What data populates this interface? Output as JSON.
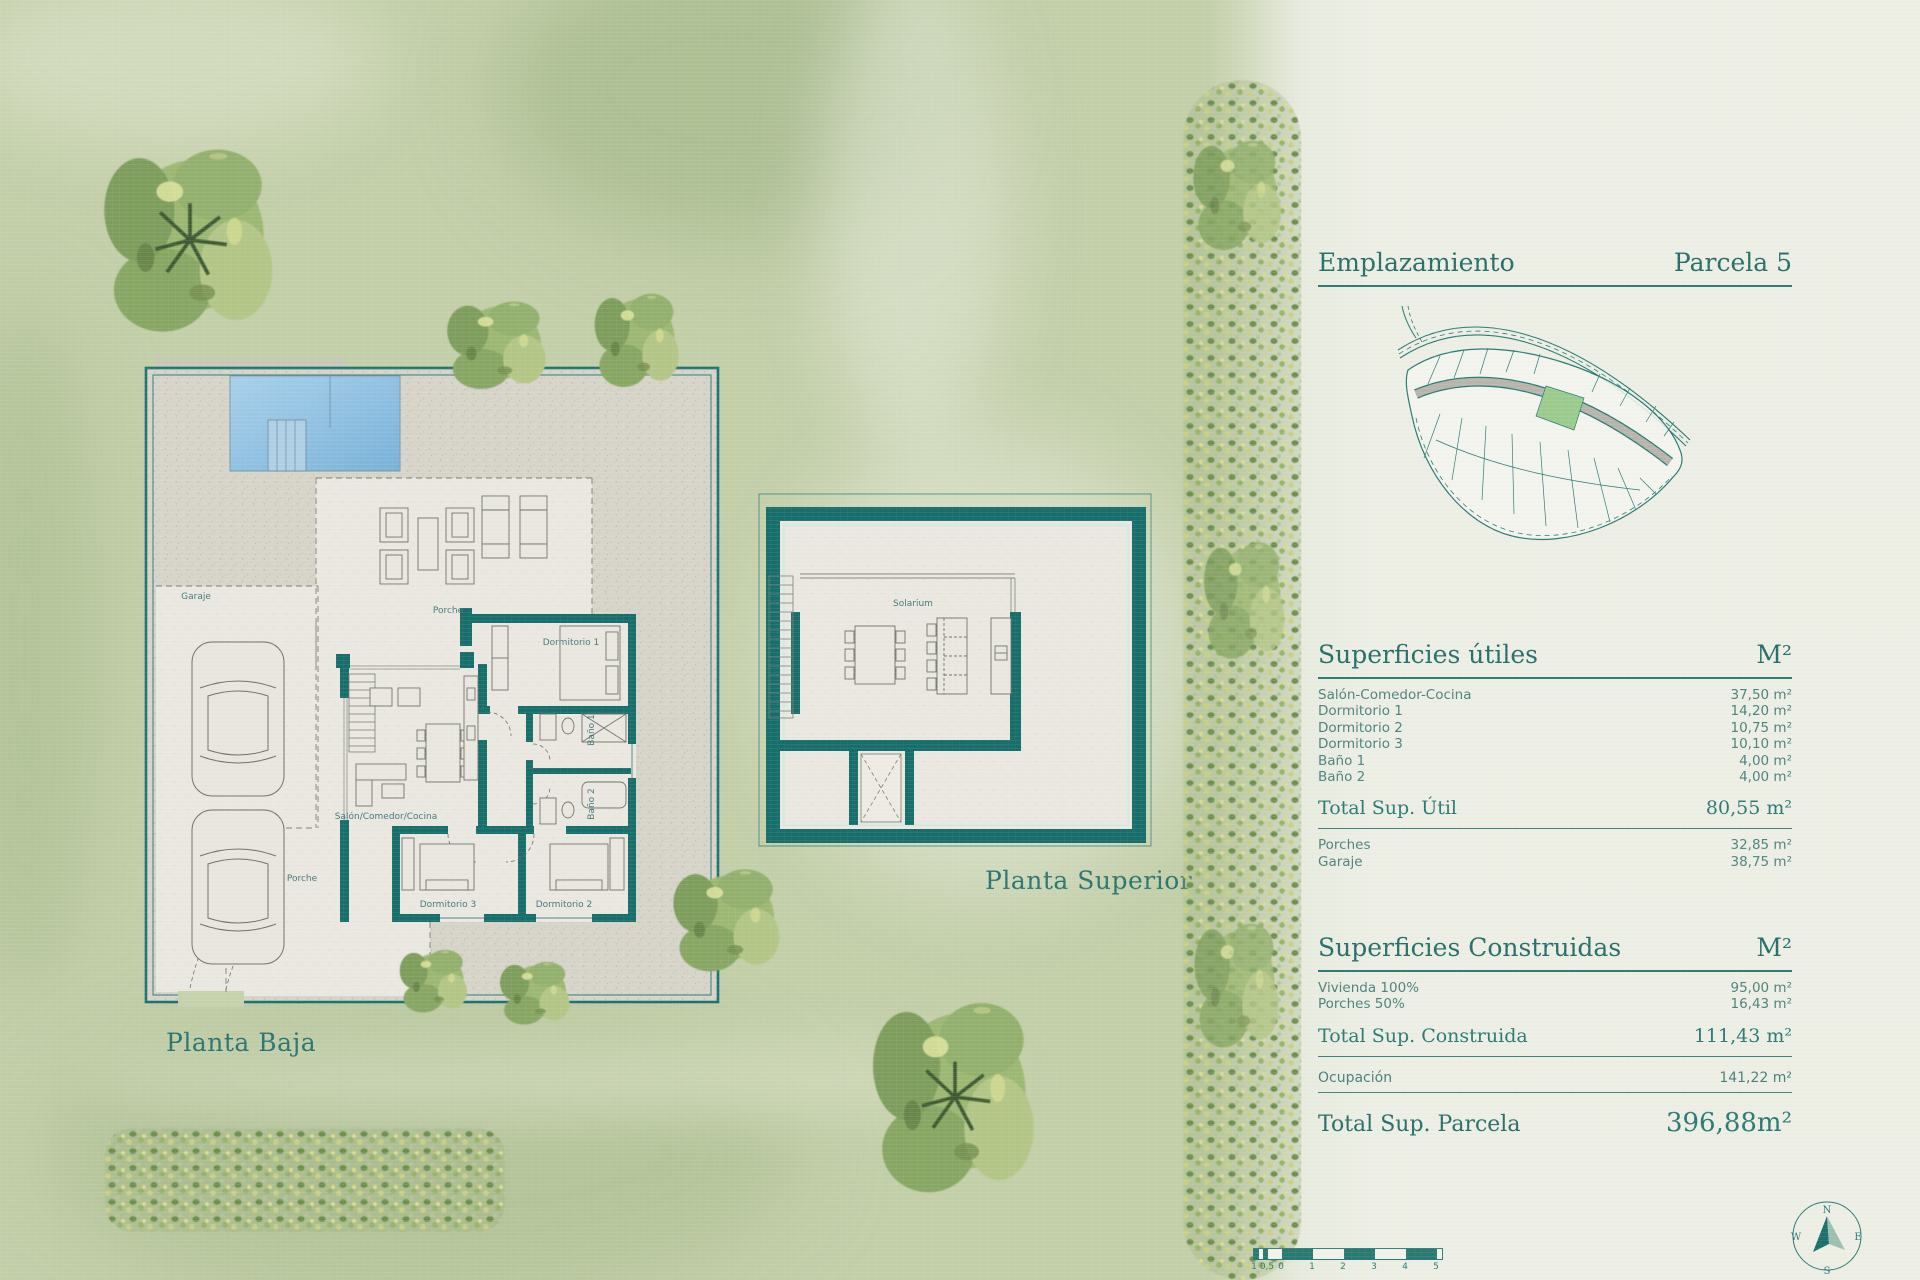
{
  "site": {
    "header": {
      "title": "Emplazamiento",
      "parcel": "Parcela 5"
    }
  },
  "plans": {
    "baja": {
      "caption": "Planta Baja",
      "rooms": {
        "garaje": "Garaje",
        "porche_top": "Porche",
        "dormitorio1": "Dormitorio 1",
        "bano1": "Baño 1",
        "bano2": "Baño 2",
        "salon": "Salón/Comedor/Cocina",
        "porche_bottom": "Porche",
        "dormitorio3": "Dormitorio 3",
        "dormitorio2": "Dormitorio 2"
      }
    },
    "superior": {
      "caption": "Planta Superior",
      "rooms": {
        "solarium": "Solarium"
      }
    }
  },
  "tables": {
    "utiles": {
      "title": "Superficies útiles",
      "unit": "M²",
      "rows": [
        {
          "label": "Salón-Comedor-Cocina",
          "value": "37,50 m²"
        },
        {
          "label": "Dormitorio 1",
          "value": "14,20 m²"
        },
        {
          "label": "Dormitorio 2",
          "value": "10,75 m²"
        },
        {
          "label": "Dormitorio 3",
          "value": "10,10 m²"
        },
        {
          "label": "Baño 1",
          "value": "4,00 m²"
        },
        {
          "label": "Baño 2",
          "value": "4,00 m²"
        }
      ],
      "total": {
        "label": "Total Sup. Útil",
        "value": "80,55 m²"
      },
      "extras": [
        {
          "label": "Porches",
          "value": "32,85 m²"
        },
        {
          "label": "Garaje",
          "value": "38,75 m²"
        }
      ]
    },
    "construidas": {
      "title": "Superficies Construidas",
      "unit": "M²",
      "rows": [
        {
          "label": "Vivienda 100%",
          "value": "95,00 m²"
        },
        {
          "label": "Porches 50%",
          "value": "16,43 m²"
        }
      ],
      "total": {
        "label": "Total Sup. Construida",
        "value": "111,43 m²"
      },
      "ocupacion": {
        "label": "Ocupación",
        "value": "141,22 m²"
      },
      "parcela": {
        "label": "Total Sup. Parcela",
        "value": "396,88m²"
      }
    }
  },
  "scalebar": {
    "labels": [
      "1",
      "0,5",
      "0",
      "1",
      "2",
      "3",
      "4",
      "5"
    ]
  },
  "compass": {
    "n": "N",
    "e": "E",
    "s": "S",
    "w": "W"
  },
  "colors": {
    "teal": "#1d7370",
    "panel_text": "#4d837d",
    "parcel_highlight": "#9ccb8e"
  }
}
